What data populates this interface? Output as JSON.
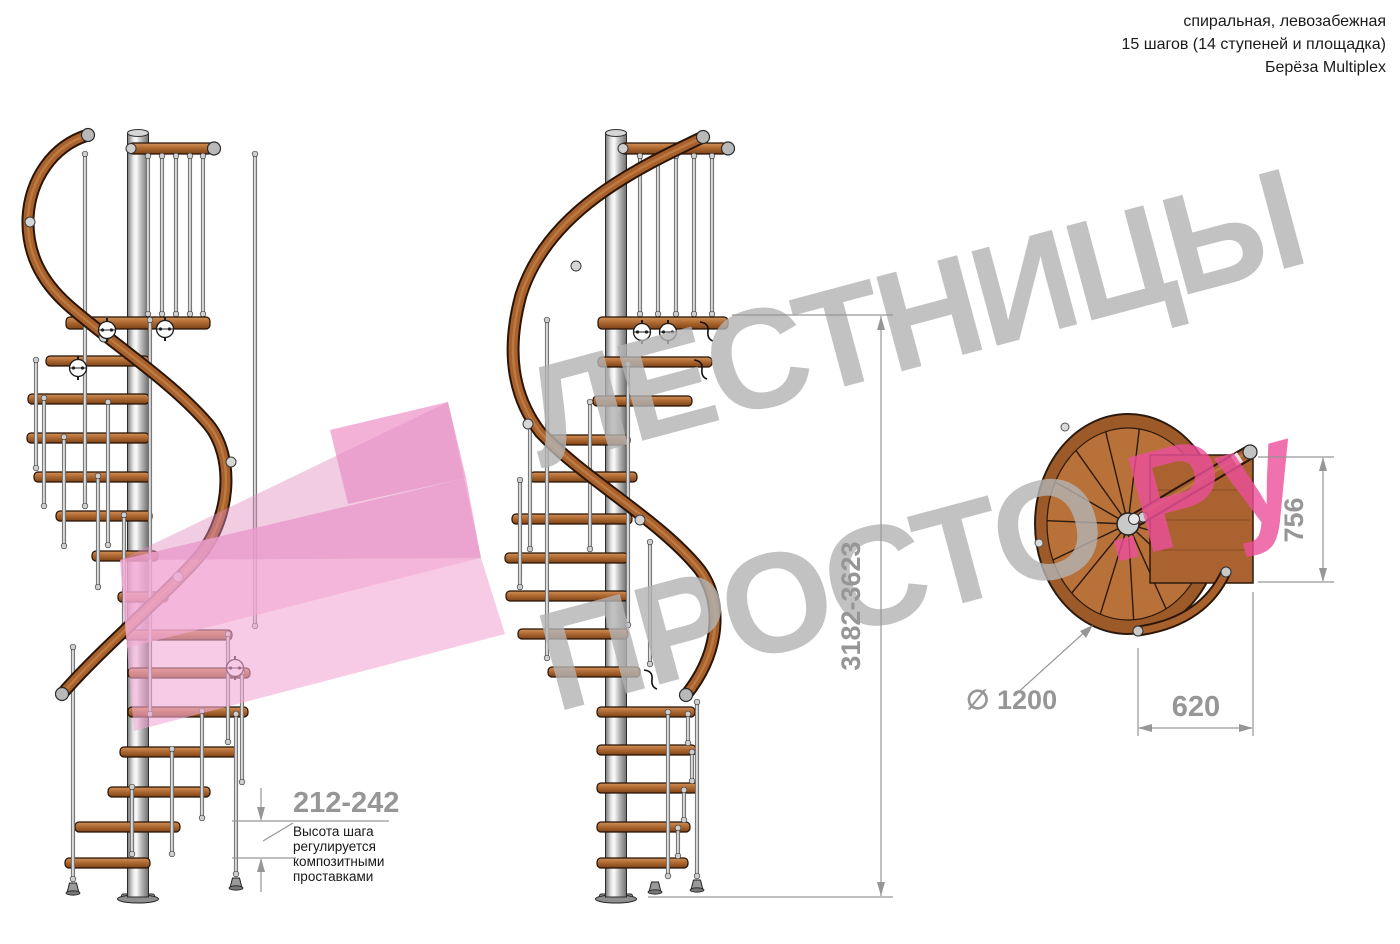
{
  "header": {
    "line1": "спиральная, левозабежная",
    "line2": "15 шагов (14 ступеней и площадка)",
    "line3": "Берёза Multiplex"
  },
  "watermark": {
    "line1": "ЛЕСТНИЦЫ",
    "line2_gray": "ПРОСТО",
    "line2_pink": ".Ру"
  },
  "dimensions": {
    "step_height": "212-242",
    "step_height_note_lines": [
      "Высота шага",
      "регулируется",
      "композитными",
      "проставками"
    ],
    "total_height": "3182-3623",
    "diameter": "∅ 1200",
    "landing_side": "620",
    "landing_depth": "756"
  },
  "colors": {
    "dim": "#969696",
    "text": "#1b1b1b",
    "wmgray": "#b4b4b4",
    "wmpink": "#ec4f9c",
    "logopink": "#f2a9d4",
    "logopink2": "#df8fc2",
    "wood": "#b9713a",
    "pole": "#d9d9d9"
  }
}
